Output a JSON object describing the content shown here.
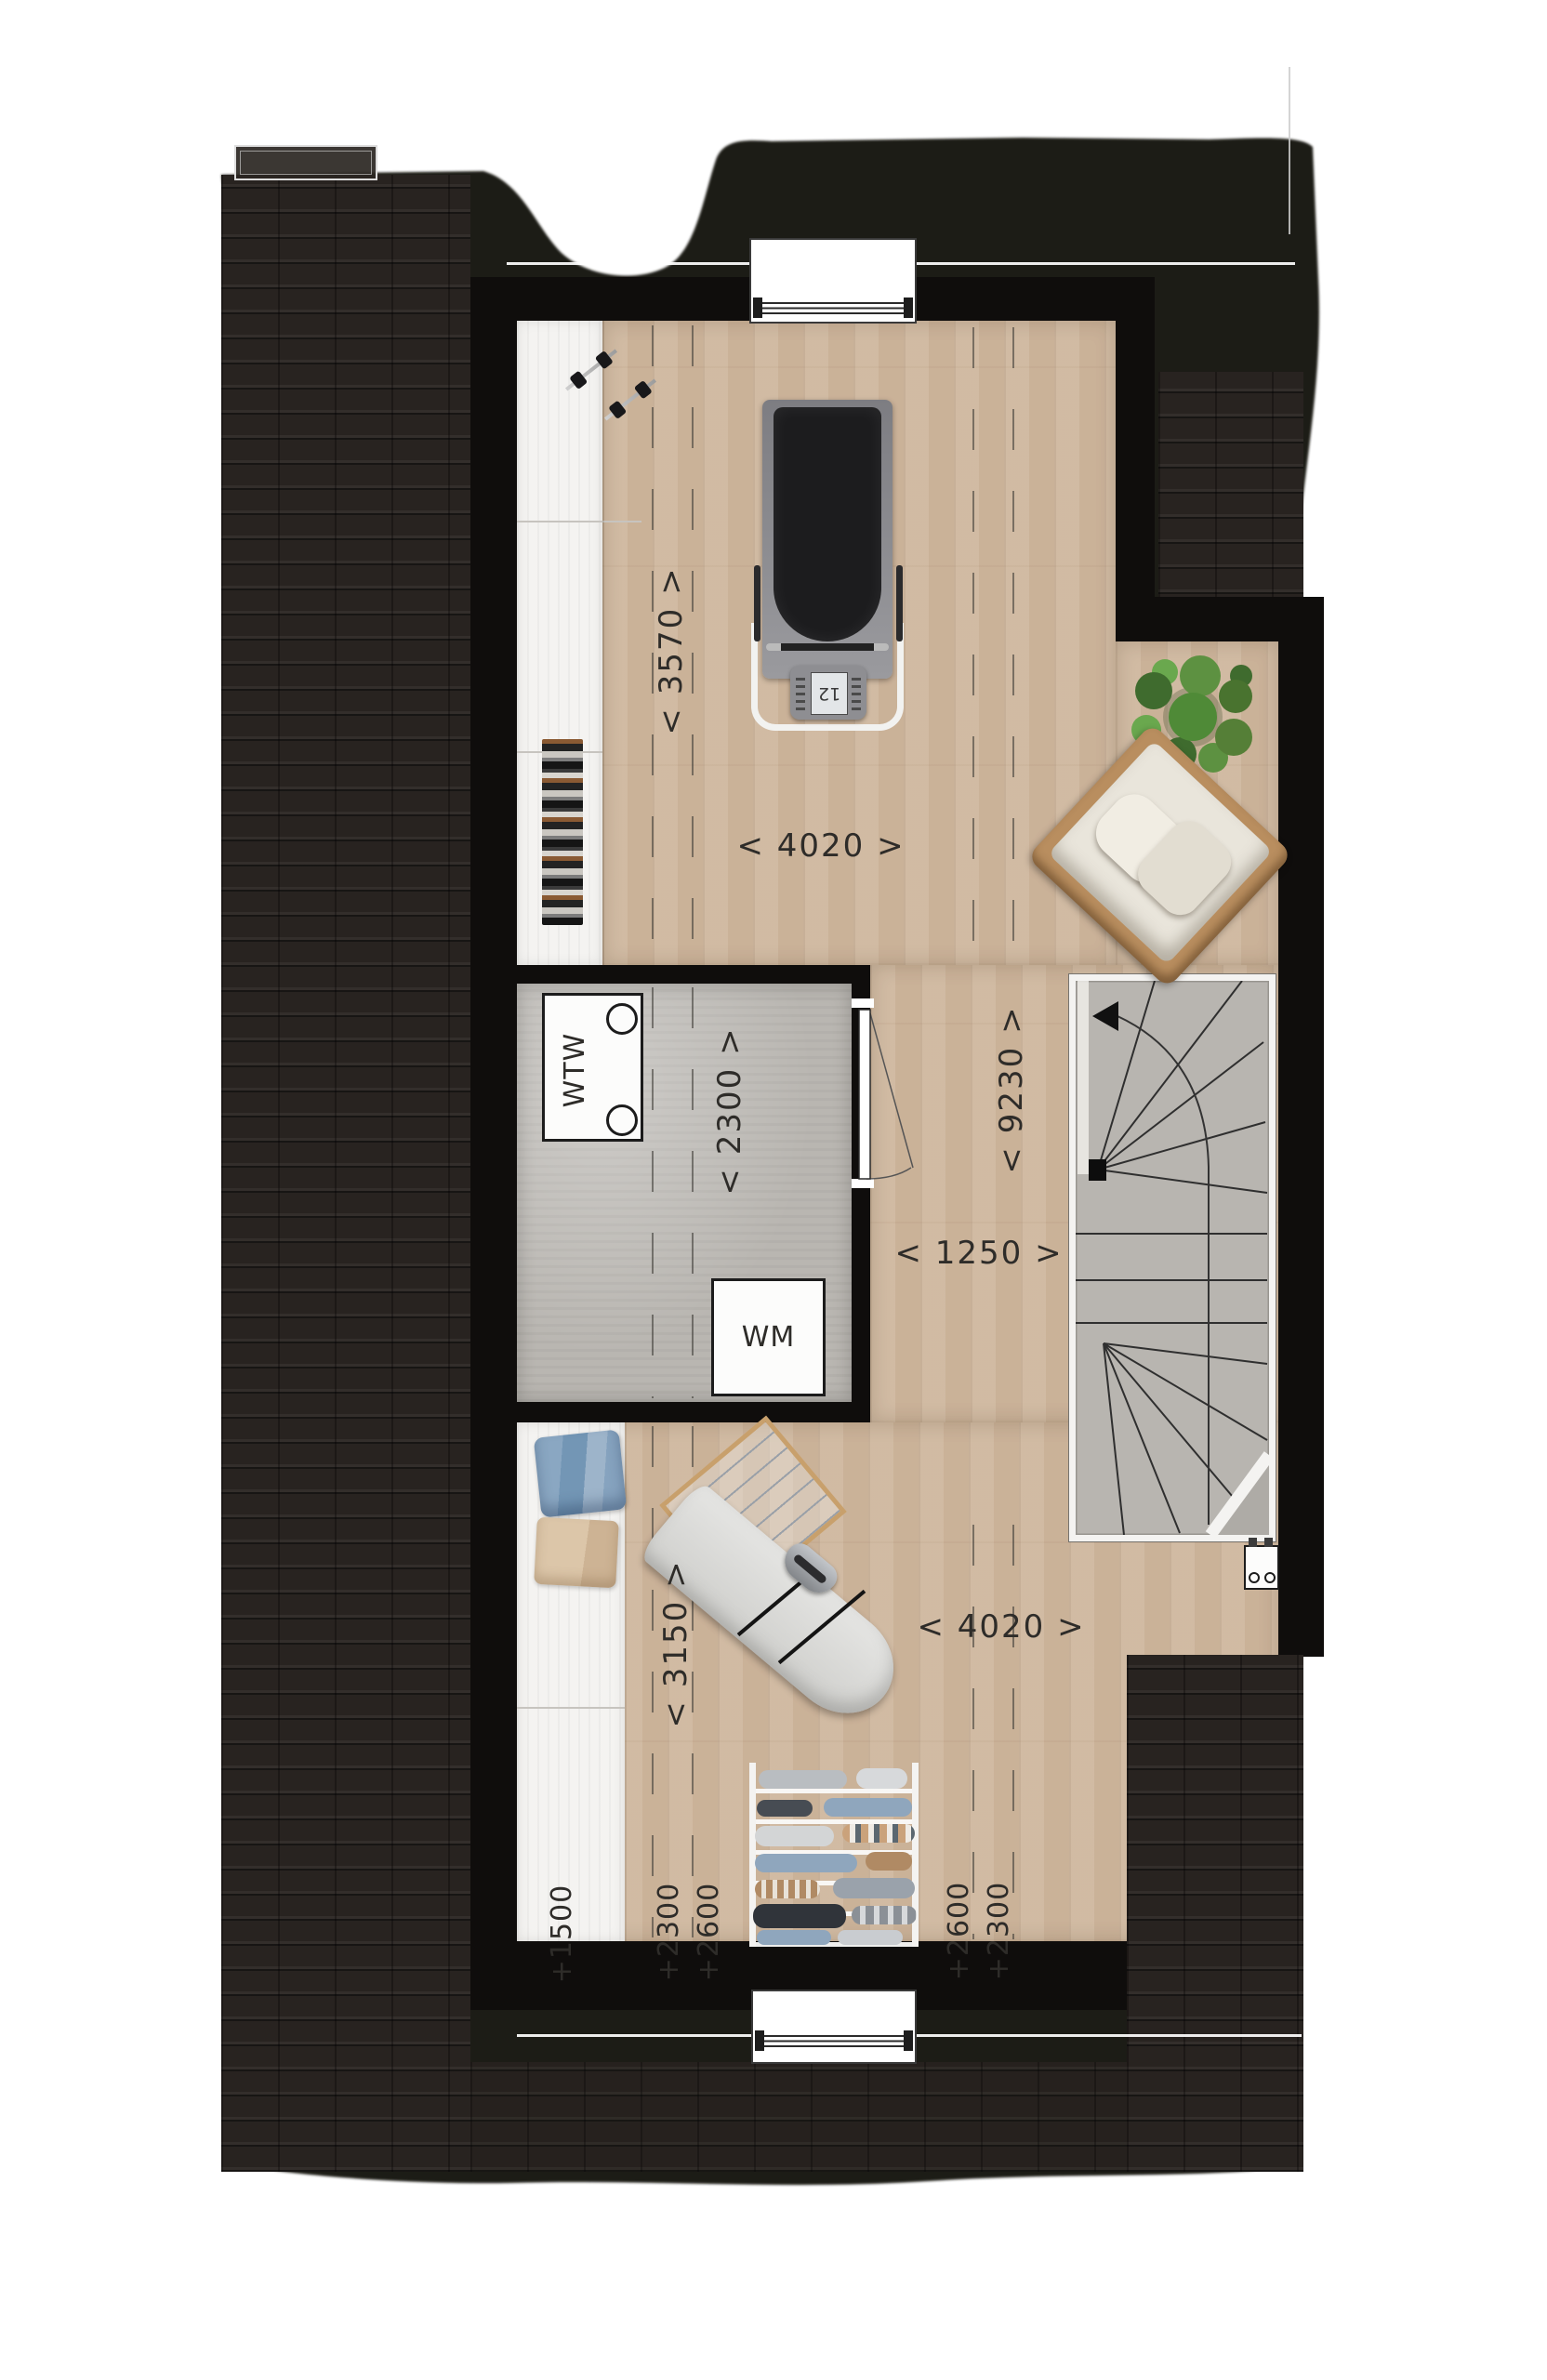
{
  "plan": {
    "type": "attic floor plan",
    "labels": {
      "d3570": "< 3570 >",
      "d4020_top": "< 4020 >",
      "d2300": "< 2300 >",
      "d9230": "< 9230 >",
      "d1250": "< 1250 >",
      "d3150": "< 3150 >",
      "d4020_bottom": "< 4020 >",
      "h1500": "+1500",
      "h2300_left": "+2300",
      "h2600_left": "+2600",
      "h2600_right": "+2600",
      "h2300_right": "+2300",
      "wtw": "WTW",
      "wm": "WM",
      "treadmill_display": "12"
    },
    "colors": {
      "roof": "#1f1b17",
      "roof_tiles": "#282320",
      "wall": "#0f0d0c",
      "wood_floor": "#cfb79e",
      "concrete_floor": "#b9b6b1",
      "knee_wall_floor": "#f4f3f1",
      "stair_treads": "#b8b5b0",
      "label_ink": "#2e2c29",
      "window_frame": "#ffffff",
      "plant_green": "#4f8a37"
    }
  }
}
